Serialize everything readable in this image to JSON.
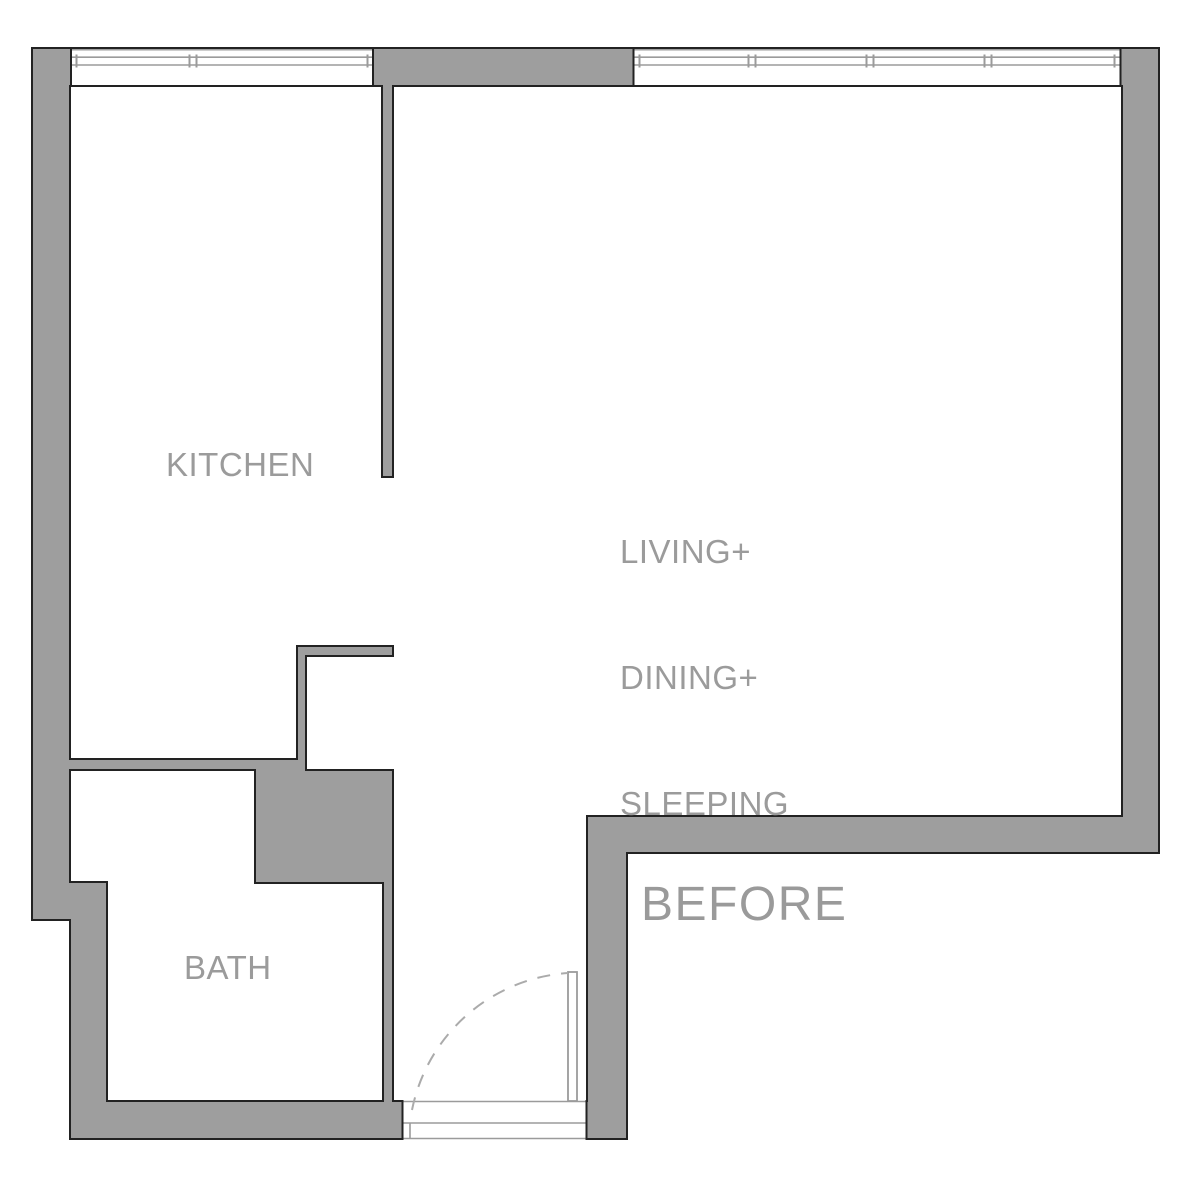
{
  "plan": {
    "stage_label": "BEFORE",
    "rooms": {
      "kitchen": {
        "label": "KITCHEN"
      },
      "living": {
        "lines": [
          "LIVING+",
          "DINING+",
          "SLEEPING"
        ]
      },
      "bath": {
        "label": "BATH"
      }
    }
  },
  "legend": {
    "element_names": [
      "exterior-and-interior-walls",
      "kitchen-window",
      "living-window",
      "entry-door-threshold",
      "entry-door-leaf",
      "door-swing-arc"
    ]
  },
  "colors": {
    "background": "#ffffff",
    "wall_fill": "#9e9e9e",
    "wall_outline": "#222222",
    "fixture_line": "#9b9b9b",
    "swing_arc": "#ababab",
    "label_text": "#9b9b9b"
  }
}
